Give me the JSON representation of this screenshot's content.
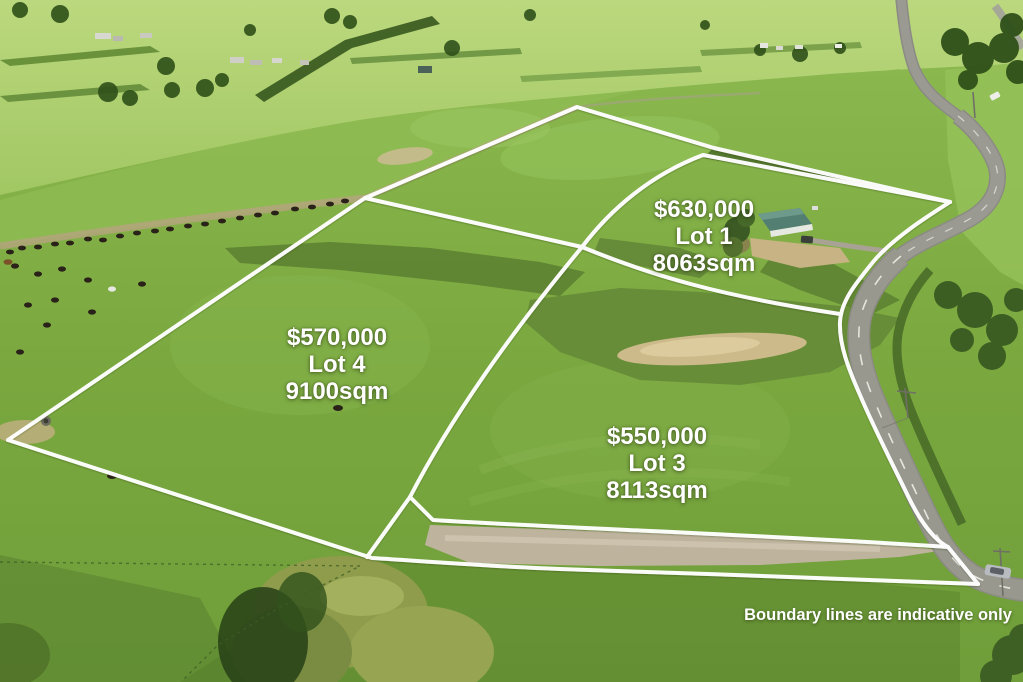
{
  "image_type": "aerial-drone-photo real-estate listing overlay",
  "lots": [
    {
      "price": "$630,000",
      "name": "Lot 1",
      "area": "8063sqm"
    },
    {
      "price": "$570,000",
      "name": "Lot 4",
      "area": "9100sqm"
    },
    {
      "price": "$550,000",
      "name": "Lot 3",
      "area": "8113sqm"
    }
  ],
  "disclaimer": "Boundary lines are indicative only",
  "colors": {
    "boundary_line": "#ffffff",
    "pasture_mid": "#7aa83f",
    "pasture_light": "#95c35b",
    "pasture_dark": "#5f8a2e",
    "distant_fields": "#b5d377",
    "scrub_olive": "#64893a",
    "scrub_dots": "#3a5820",
    "dirt_tan": "#cdba8b",
    "road_asphalt": "#98988f",
    "gravel": "#beb49e",
    "house_roof_teal": "#527f72",
    "tree_dark": "#2f5019",
    "label_text": "#ffffff"
  }
}
